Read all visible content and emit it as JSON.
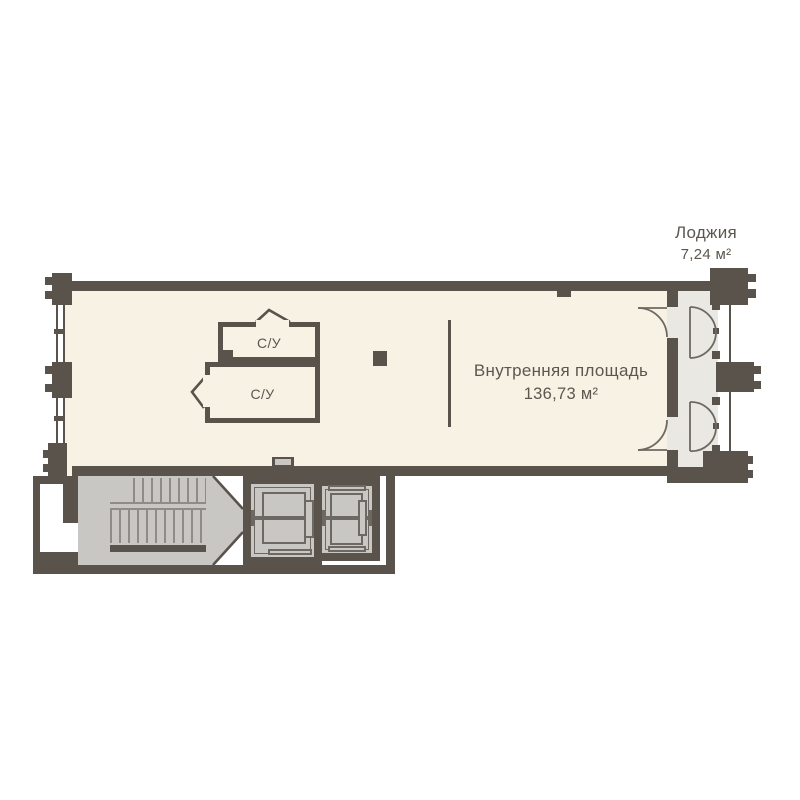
{
  "labels": {
    "loggia": {
      "name": "Лоджия",
      "area": "7,24 м²"
    },
    "main_room": {
      "name": "Внутренняя площадь",
      "area": "136,73 м²"
    },
    "bathroom_top": "С/У",
    "bathroom_bottom": "С/У"
  },
  "colors": {
    "background": "#ffffff",
    "wall": "#59534c",
    "room_fill": "#f8f2e5",
    "loggia_fill": "#e9e8e3",
    "stair_fill": "#c8c7c3",
    "detail_line": "#6e6862",
    "step_line": "#8f8c87",
    "text": "#5c564f"
  }
}
